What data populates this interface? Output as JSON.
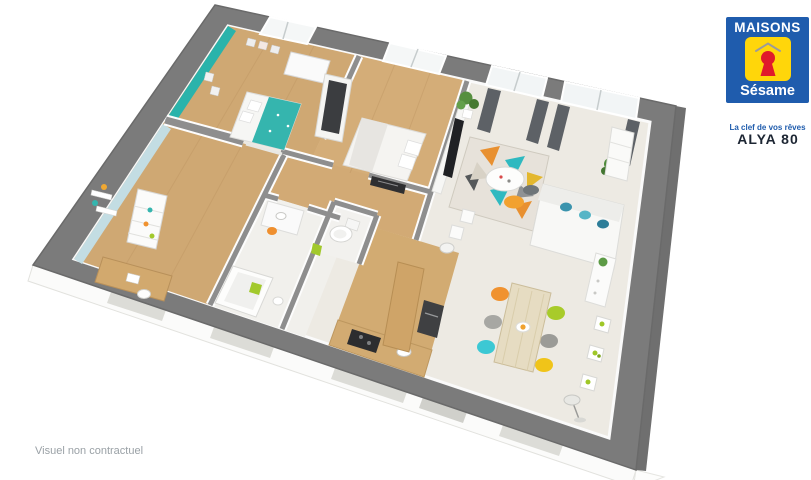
{
  "logo": {
    "brand": "MAISONS",
    "sub_brand": "Sésame",
    "tagline": "La clef de vos rêves",
    "colors": {
      "blue": "#1f5cad",
      "yellow": "#ffd60a",
      "red": "#e01a2b"
    }
  },
  "plan": {
    "model_label": "ALYA 80"
  },
  "footer": {
    "disclaimer": "Visuel non contractuel"
  },
  "floor_plan": {
    "type": "3d-floor-plan",
    "palette": {
      "outer_wall_gray": "#7b7b7b",
      "inner_wall_gray": "#8e8e8e",
      "wood_floor": "#cfa873",
      "living_floor": "#edeae3",
      "teal_accent": "#2ab3ab",
      "light_blue_accent": "#c3dde3",
      "lime_accent": "#a2c92c",
      "orange_accent": "#f0922f",
      "cyan_chair": "#3cc8d4",
      "yellow_chair": "#f0c419",
      "curtain_gray": "#5d6166",
      "plant_green": "#568f3f"
    },
    "rooms": [
      {
        "id": "bedroom-teal",
        "accent": "#2ab3ab",
        "floor": "wood"
      },
      {
        "id": "bedroom-center",
        "accent": "#ffffff",
        "floor": "wood"
      },
      {
        "id": "bedroom-blue",
        "accent": "#c3dde3",
        "floor": "wood"
      },
      {
        "id": "bathroom",
        "accent": "#a2c92c",
        "floor": "white"
      },
      {
        "id": "wc",
        "accent": "#ffffff",
        "floor": "white"
      },
      {
        "id": "kitchen",
        "accent": "#cfa873",
        "floor": "wood"
      },
      {
        "id": "living-dining",
        "accent": "#edeae3",
        "floor": "light"
      },
      {
        "id": "hallway",
        "accent": "#cfa873",
        "floor": "wood"
      }
    ]
  }
}
